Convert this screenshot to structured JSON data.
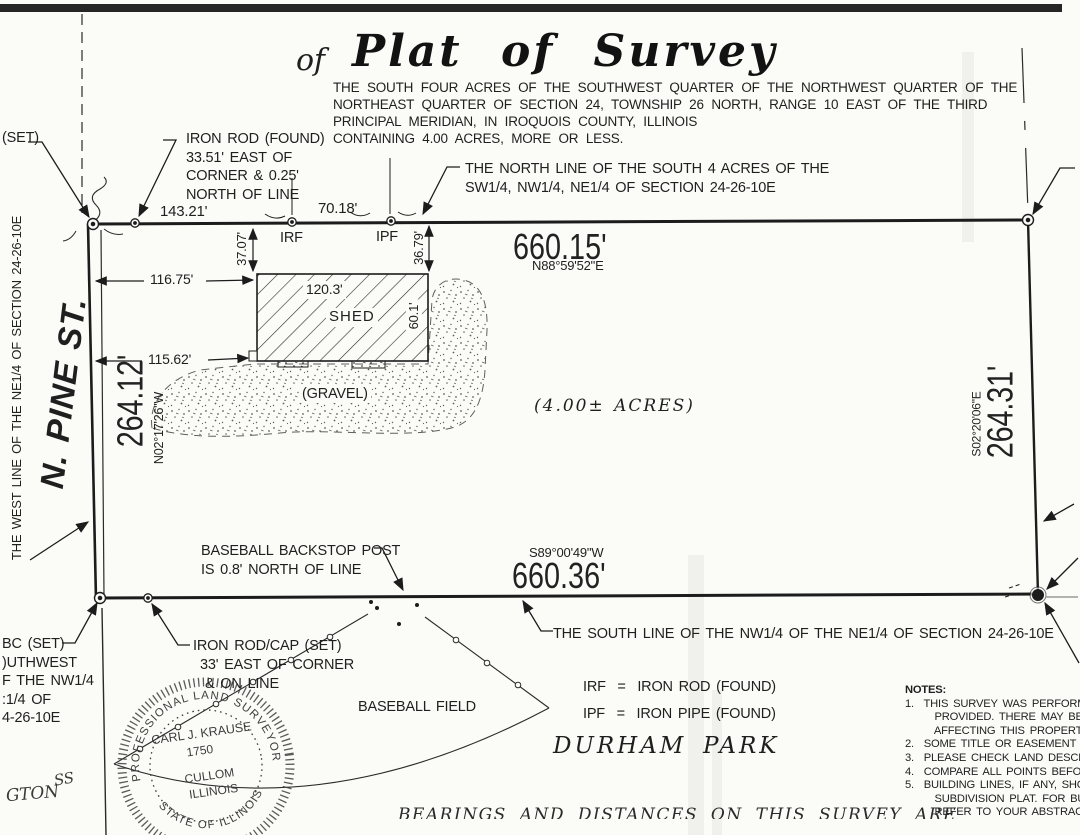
{
  "page": {
    "of_label": "of",
    "title": "Plat of Survey",
    "description_lines": [
      "THE SOUTH FOUR ACRES OF THE SOUTHWEST QUARTER OF THE NORTHWEST QUARTER OF THE",
      "NORTHEAST QUARTER OF SECTION 24, TOWNSHIP 26 NORTH, RANGE 10 EAST OF THE THIRD",
      "PRINCIPAL MERIDIAN, IN IROQUOIS COUNTY, ILLINOIS",
      "CONTAINING 4.00 ACRES, MORE OR LESS."
    ]
  },
  "north": {
    "set_label": "(SET)",
    "iron_rod_note_lines": [
      "IRON ROD (FOUND)",
      "33.51' EAST OF",
      "CORNER & 0.25'",
      "NORTH OF LINE"
    ],
    "dim_left": "143.21'",
    "dim_right": "70.18'",
    "irf": "IRF",
    "ipf": "IPF",
    "line_note_lines": [
      "THE NORTH LINE OF THE SOUTH 4 ACRES OF THE",
      "SW1/4, NW1/4, NE1/4 OF SECTION 24-26-10E"
    ],
    "distance": "660.15'",
    "bearing": "N88°59'52\"E"
  },
  "west": {
    "street_name": "N. PINE ST.",
    "line_label": "THE WEST LINE OF THE NE1/4 OF SECTION 24-26-10E",
    "distance": "264.12'",
    "bearing": "N02°17'26\"W"
  },
  "east": {
    "distance": "264.31'",
    "bearing": "S02°20'06\"E"
  },
  "south": {
    "bearing": "S89°00'49\"W",
    "distance": "660.36'",
    "backstop_note_lines": [
      "BASEBALL BACKSTOP POST",
      "IS 0.8' NORTH OF LINE"
    ],
    "line_note": "THE SOUTH LINE OF THE NW1/4 OF THE NE1/4 OF SECTION 24-26-10E",
    "sw_corner_note_lines": [
      "BC (SET)",
      ")UTHWEST",
      "F THE NW1/4",
      ":1/4 OF",
      "4-26-10E"
    ],
    "iron_rod_cap_note_lines": [
      "IRON ROD/CAP (SET)",
      "33' EAST OF CORNER",
      "& ON LINE"
    ]
  },
  "parcel": {
    "shed_label": "SHED",
    "shed_width": "120.3'",
    "shed_depth": "60.1'",
    "gravel_label": "(GRAVEL)",
    "area_label": "(4.00± ACRES)",
    "dim_west_to_shed_north": "116.75'",
    "dim_west_to_shed_south": "115.62'",
    "dim_line_to_shed_west": "37.07'",
    "dim_line_to_shed_east": "36.79'"
  },
  "park": {
    "field_label": "BASEBALL FIELD",
    "name_word1": "DURHAM",
    "name_word2": "PARK"
  },
  "legend": {
    "irf": "IRF  =  IRON ROD (FOUND)",
    "ipf": "IPF  =  IRON PIPE (FOUND)"
  },
  "seal": {
    "arc_top": "PROFESSIONAL LAND SURVEYOR",
    "arc_bottom": "STATE OF ILLINOIS",
    "name": "CARL J. KRAUSE",
    "number": "1750",
    "city": "CULLOM",
    "state": "ILLINOIS"
  },
  "notes": {
    "heading": "NOTES:",
    "lines": [
      "1.  THIS SURVEY WAS PERFORME",
      "      PROVIDED. THERE MAY BE EA",
      "      AFFECTING THIS PROPERTY W",
      "2.  SOME TITLE OR EASEMENT DO",
      "3.  PLEASE CHECK LAND DESCRIP",
      "4.  COMPARE ALL POINTS BEFORE",
      "5.  BUILDING LINES, IF ANY, SHO",
      "      SUBDIVISION PLAT. FOR BUILD",
      "      REFER TO YOUR ABSTRACT D"
    ]
  },
  "misc": {
    "corner_word": "GTON",
    "corner_ss": "SS",
    "bottom_clipped": "BEARINGS  AND  DISTANCES  ON  THIS  SURVEY  ARE"
  }
}
